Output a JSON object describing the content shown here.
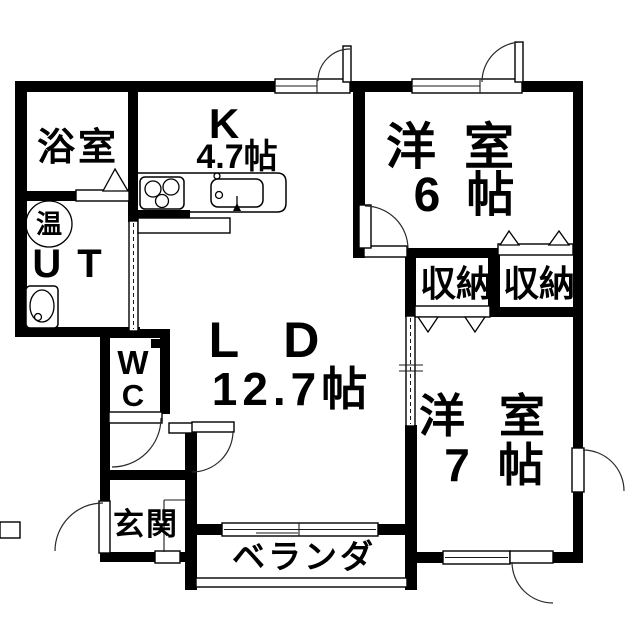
{
  "fp": {
    "rooms": {
      "bathroom": {
        "label": "浴室"
      },
      "utility": {
        "label": "UT",
        "hot_water_mark": "温"
      },
      "wc": {
        "label": "WC",
        "line1": "W",
        "line2": "C"
      },
      "kitchen": {
        "label": "K",
        "size": "4.7帖"
      },
      "living_dining": {
        "label": "LD",
        "size": "12.7帖"
      },
      "western_room_6": {
        "label": "洋室",
        "size": "6帖"
      },
      "western_room_7": {
        "label": "洋室",
        "size": "7帖"
      },
      "storage_left": {
        "label": "収納"
      },
      "storage_right": {
        "label": "収納"
      },
      "entrance": {
        "label": "玄関"
      },
      "veranda": {
        "label": "ベランダ"
      }
    },
    "colors": {
      "wall": "#000000",
      "background": "#ffffff",
      "line": "#1a1a1a"
    }
  }
}
